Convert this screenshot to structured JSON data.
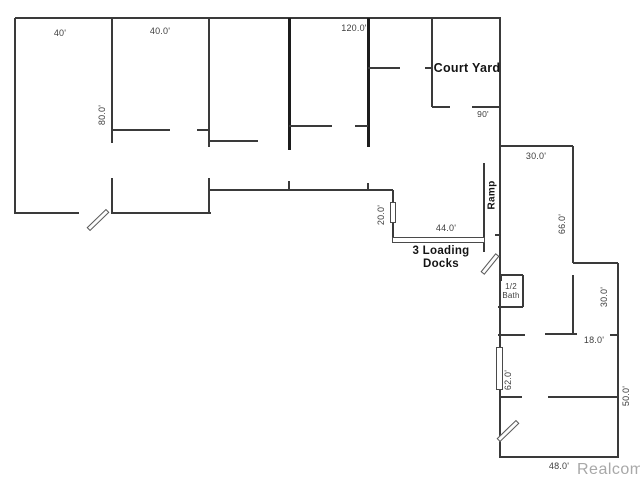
{
  "watermark": {
    "text": "Realcomp",
    "x": 577,
    "y": 470,
    "color": "#a8a8a8"
  },
  "floorplan": {
    "background": "#ffffff",
    "wall_color": "#3a3a3a",
    "thick_wall_color": "#1c1c1c",
    "labels": [
      {
        "id": "dim-40",
        "text": "40'",
        "x": 60,
        "y": 33,
        "rot": 0,
        "bold": false,
        "size": 9
      },
      {
        "id": "dim-40-0",
        "text": "40.0'",
        "x": 160,
        "y": 31,
        "rot": 0,
        "bold": false,
        "size": 9
      },
      {
        "id": "dim-120",
        "text": "120.0'",
        "x": 354,
        "y": 28,
        "rot": 0,
        "bold": false,
        "size": 9
      },
      {
        "id": "court-yard",
        "text": "Court Yard",
        "x": 467,
        "y": 68,
        "rot": 0,
        "bold": true,
        "size": 12.5
      },
      {
        "id": "dim-90",
        "text": "90'",
        "x": 483,
        "y": 115,
        "rot": 0,
        "bold": false,
        "size": 8.5
      },
      {
        "id": "dim-30-top",
        "text": "30.0'",
        "x": 536,
        "y": 156,
        "rot": 0,
        "bold": false,
        "size": 9
      },
      {
        "id": "ramp",
        "text": "Ramp",
        "x": 492,
        "y": 195,
        "rot": -90,
        "bold": true,
        "size": 10
      },
      {
        "id": "dim-66",
        "text": "66.0'",
        "x": 562,
        "y": 224,
        "rot": -90,
        "bold": false,
        "size": 9
      },
      {
        "id": "dim-80",
        "text": "80.0'",
        "x": 102,
        "y": 115,
        "rot": -90,
        "bold": false,
        "size": 9
      },
      {
        "id": "dim-20",
        "text": "20.0'",
        "x": 381,
        "y": 215,
        "rot": -90,
        "bold": false,
        "size": 9
      },
      {
        "id": "dim-44",
        "text": "44.0'",
        "x": 446,
        "y": 228,
        "rot": 0,
        "bold": false,
        "size": 9
      },
      {
        "id": "loading-docks",
        "text": "3 Loading\nDocks",
        "x": 441,
        "y": 258,
        "rot": 0,
        "bold": true,
        "size": 11.5
      },
      {
        "id": "half-bath",
        "text": "1/2\nBath",
        "x": 511,
        "y": 291,
        "rot": 0,
        "bold": false,
        "size": 8
      },
      {
        "id": "dim-30-right",
        "text": "30.0'",
        "x": 604,
        "y": 297,
        "rot": -90,
        "bold": false,
        "size": 9
      },
      {
        "id": "dim-18",
        "text": "18.0'",
        "x": 594,
        "y": 340,
        "rot": 0,
        "bold": false,
        "size": 9
      },
      {
        "id": "dim-62",
        "text": "62.0'",
        "x": 508,
        "y": 380,
        "rot": -90,
        "bold": false,
        "size": 9
      },
      {
        "id": "dim-50",
        "text": "50.0'",
        "x": 626,
        "y": 396,
        "rot": -90,
        "bold": false,
        "size": 9
      },
      {
        "id": "dim-48",
        "text": "48.0'",
        "x": 559,
        "y": 466,
        "rot": 0,
        "bold": false,
        "size": 9
      }
    ],
    "walls": [
      {
        "x1": 15,
        "y1": 18,
        "x2": 501,
        "y2": 18,
        "t": 2
      },
      {
        "x1": 15,
        "y1": 18,
        "x2": 15,
        "y2": 214,
        "t": 2
      },
      {
        "x1": 112,
        "y1": 18,
        "x2": 112,
        "y2": 143,
        "t": 2
      },
      {
        "x1": 112,
        "y1": 178,
        "x2": 112,
        "y2": 214,
        "t": 2
      },
      {
        "x1": 209,
        "y1": 18,
        "x2": 209,
        "y2": 147,
        "t": 2
      },
      {
        "x1": 209,
        "y1": 178,
        "x2": 209,
        "y2": 213,
        "t": 2
      },
      {
        "x1": 289,
        "y1": 18,
        "x2": 289,
        "y2": 150,
        "t": 3,
        "thick": true
      },
      {
        "x1": 289,
        "y1": 181,
        "x2": 289,
        "y2": 191,
        "t": 2
      },
      {
        "x1": 368,
        "y1": 18,
        "x2": 368,
        "y2": 147,
        "t": 3,
        "thick": true
      },
      {
        "x1": 368,
        "y1": 183,
        "x2": 368,
        "y2": 191,
        "t": 2
      },
      {
        "x1": 432,
        "y1": 18,
        "x2": 432,
        "y2": 107,
        "t": 2
      },
      {
        "x1": 500,
        "y1": 18,
        "x2": 500,
        "y2": 348,
        "t": 2
      },
      {
        "x1": 500,
        "y1": 390,
        "x2": 500,
        "y2": 458,
        "t": 2
      },
      {
        "x1": 15,
        "y1": 213,
        "x2": 79,
        "y2": 213,
        "t": 2
      },
      {
        "x1": 112,
        "y1": 213,
        "x2": 211,
        "y2": 213,
        "t": 2
      },
      {
        "x1": 113,
        "y1": 130,
        "x2": 170,
        "y2": 130,
        "t": 2
      },
      {
        "x1": 197,
        "y1": 130,
        "x2": 209,
        "y2": 130,
        "t": 2
      },
      {
        "x1": 209,
        "y1": 141,
        "x2": 258,
        "y2": 141,
        "t": 2
      },
      {
        "x1": 289,
        "y1": 126,
        "x2": 332,
        "y2": 126,
        "t": 2
      },
      {
        "x1": 355,
        "y1": 126,
        "x2": 368,
        "y2": 126,
        "t": 2
      },
      {
        "x1": 368,
        "y1": 68,
        "x2": 400,
        "y2": 68,
        "t": 2
      },
      {
        "x1": 425,
        "y1": 68,
        "x2": 432,
        "y2": 68,
        "t": 2
      },
      {
        "x1": 432,
        "y1": 107,
        "x2": 450,
        "y2": 107,
        "t": 2
      },
      {
        "x1": 472,
        "y1": 107,
        "x2": 501,
        "y2": 107,
        "t": 2
      },
      {
        "x1": 209,
        "y1": 190,
        "x2": 393,
        "y2": 190,
        "t": 2
      },
      {
        "x1": 393,
        "y1": 190,
        "x2": 393,
        "y2": 204,
        "t": 2
      },
      {
        "x1": 393,
        "y1": 222,
        "x2": 393,
        "y2": 240,
        "t": 2
      },
      {
        "x1": 500,
        "y1": 146,
        "x2": 573,
        "y2": 146,
        "t": 2
      },
      {
        "x1": 573,
        "y1": 146,
        "x2": 573,
        "y2": 263,
        "t": 2
      },
      {
        "x1": 573,
        "y1": 275,
        "x2": 573,
        "y2": 335,
        "t": 2
      },
      {
        "x1": 573,
        "y1": 263,
        "x2": 618,
        "y2": 263,
        "t": 2
      },
      {
        "x1": 618,
        "y1": 263,
        "x2": 618,
        "y2": 458,
        "t": 2
      },
      {
        "x1": 500,
        "y1": 457,
        "x2": 618,
        "y2": 457,
        "t": 2
      },
      {
        "x1": 484,
        "y1": 163,
        "x2": 484,
        "y2": 252,
        "t": 2
      },
      {
        "x1": 500,
        "y1": 275,
        "x2": 523,
        "y2": 275,
        "t": 2
      },
      {
        "x1": 523,
        "y1": 275,
        "x2": 523,
        "y2": 307,
        "t": 2
      },
      {
        "x1": 498,
        "y1": 307,
        "x2": 523,
        "y2": 307,
        "t": 2
      },
      {
        "x1": 501,
        "y1": 275,
        "x2": 501,
        "y2": 281,
        "t": 1.5
      },
      {
        "x1": 498,
        "y1": 335,
        "x2": 525,
        "y2": 335,
        "t": 2
      },
      {
        "x1": 545,
        "y1": 334,
        "x2": 577,
        "y2": 334,
        "t": 2
      },
      {
        "x1": 610,
        "y1": 335,
        "x2": 618,
        "y2": 335,
        "t": 2
      },
      {
        "x1": 500,
        "y1": 397,
        "x2": 522,
        "y2": 397,
        "t": 2
      },
      {
        "x1": 548,
        "y1": 397,
        "x2": 618,
        "y2": 397,
        "t": 2
      },
      {
        "x1": 495,
        "y1": 235,
        "x2": 500,
        "y2": 235,
        "t": 2
      }
    ],
    "openings": [
      {
        "id": "dock-door-side",
        "x": 390,
        "y": 202,
        "w": 6,
        "h": 21
      },
      {
        "id": "dock-doors-front",
        "x": 392,
        "y": 237,
        "w": 93,
        "h": 6
      },
      {
        "id": "window",
        "x": 496,
        "y": 347,
        "w": 7,
        "h": 43
      }
    ],
    "door_swings": [
      {
        "id": "entry-door-left",
        "x": 97.5,
        "y": 220,
        "len": 27,
        "w": 5,
        "angle": -44
      },
      {
        "id": "ramp-door",
        "x": 489.5,
        "y": 264,
        "len": 24,
        "w": 5,
        "angle": -51
      },
      {
        "id": "entry-door-bottom",
        "x": 507.5,
        "y": 431,
        "len": 27,
        "w": 5,
        "angle": -44
      }
    ]
  }
}
